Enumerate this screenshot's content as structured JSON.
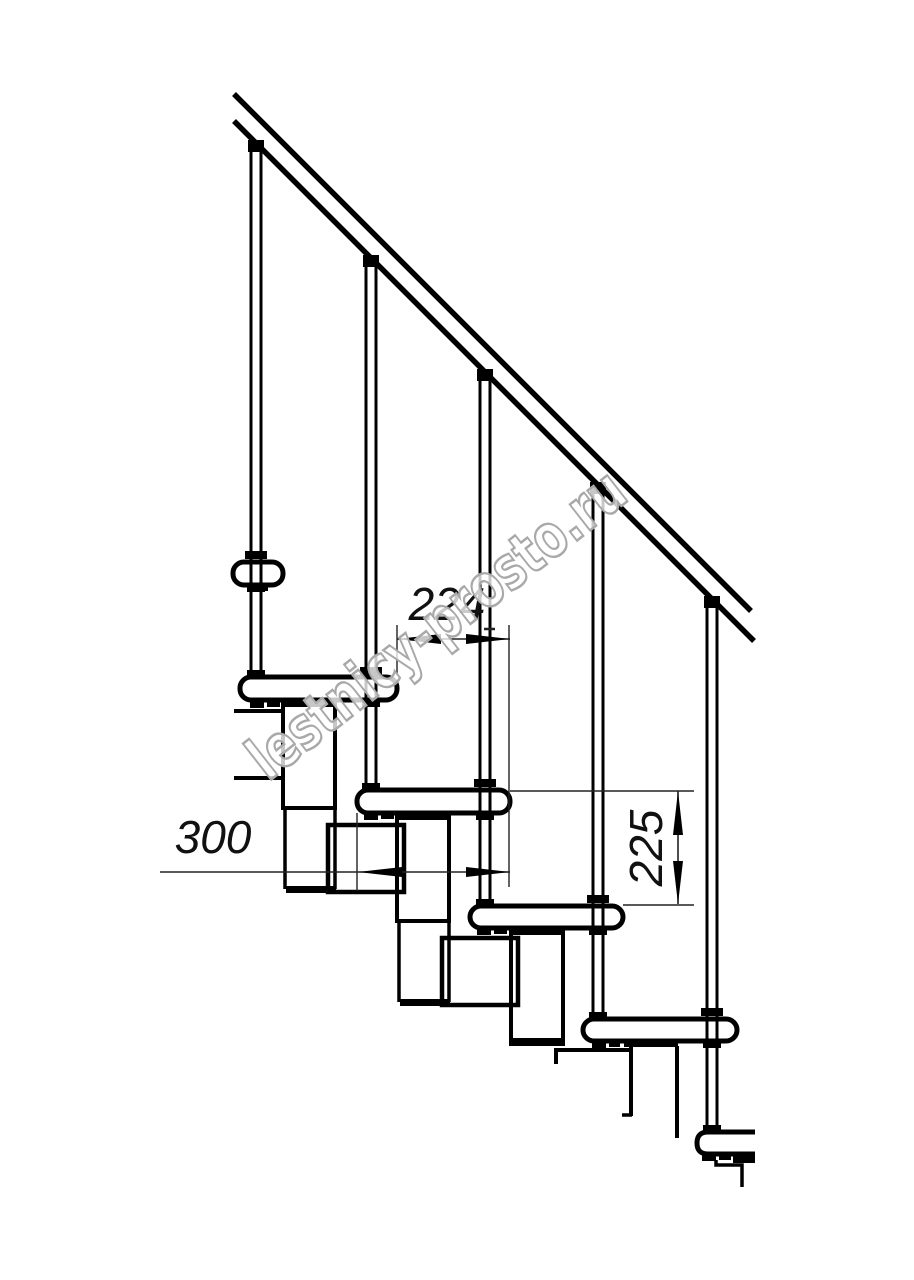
{
  "page": {
    "title": "Modular staircase side-view technical drawing",
    "background": "#ffffff",
    "line_color": "#000000"
  },
  "drawing": {
    "type": "staircase-fragment-elevation",
    "components": {
      "handrail_count": 1,
      "baluster_count": 5,
      "tread_count": 6,
      "support_module_count": 5
    },
    "dimensions": [
      {
        "id": "dim-224",
        "value": "224",
        "orientation": "horizontal",
        "meaning": "step run"
      },
      {
        "id": "dim-300",
        "value": "300",
        "orientation": "horizontal",
        "meaning": "tread depth"
      },
      {
        "id": "dim-225",
        "value": "225",
        "orientation": "vertical",
        "meaning": "riser height"
      }
    ],
    "watermark": {
      "text": "lestnicy-prosto.ru",
      "color": "#a9a9a9",
      "fill": "#ffffff"
    }
  }
}
